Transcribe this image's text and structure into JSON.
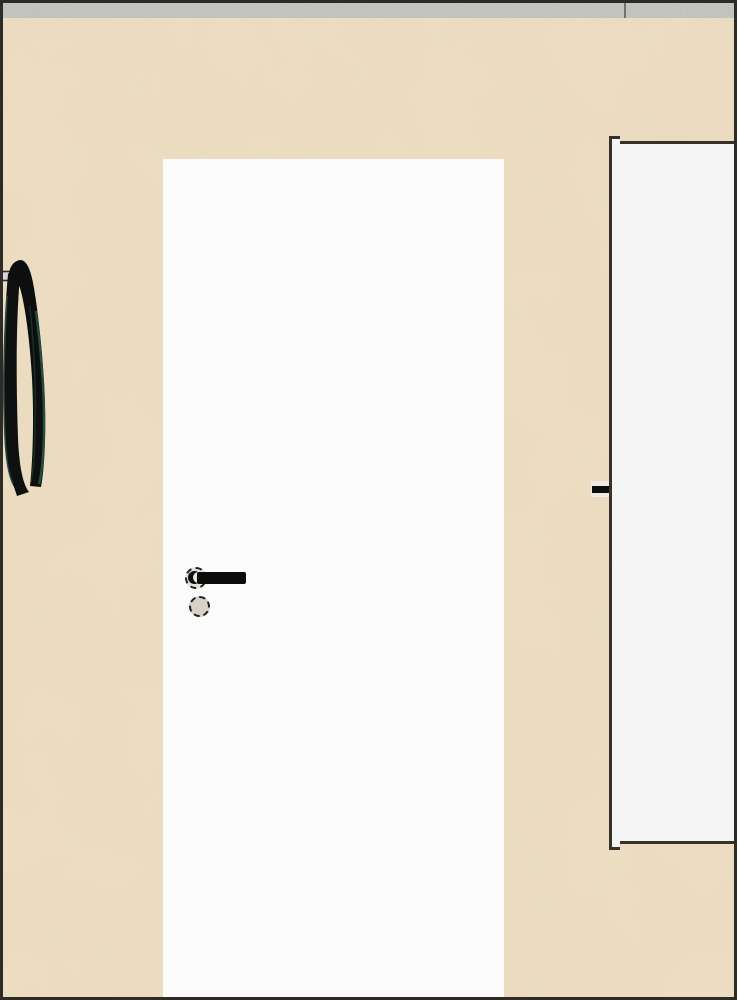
{
  "scene": {
    "kind": "rendered-interior-room-view",
    "objects": [
      "beige wall",
      "closed white door with black lever handle",
      "white side panel door",
      "black strap hanging on wall hook",
      "gray stone floor strip"
    ],
    "outer_border_color": "#2e2a25",
    "wall": {
      "color": "#eddec3",
      "texture_tint": "#8c7854"
    },
    "floor": {
      "color": "#c9ccc7",
      "seam_color": "#70736e"
    },
    "door": {
      "color": "#fcfcfd",
      "handle": {
        "lever_color": "#0b0b0b",
        "top_rosette_color": "#e4e1da",
        "top_hub_color": "#e6e3dc",
        "bottom_rosette_color": "#d8d1c6",
        "ring_color": "#1f1f1f"
      }
    },
    "side_panel": {
      "color": "#f5f5f6",
      "border_color": "#38312a",
      "handle_color": "#0d0d0d",
      "handle_backplate_color": "#f0ebe2"
    },
    "strap": {
      "color": "#0e110f",
      "color_secondary": "#0c0f0d",
      "highlight_color": "#2b564b",
      "highlight_dark_color": "#1c3b33",
      "hook_color": "#d7d6d2",
      "hook_edge_color": "#2e2c28"
    }
  }
}
